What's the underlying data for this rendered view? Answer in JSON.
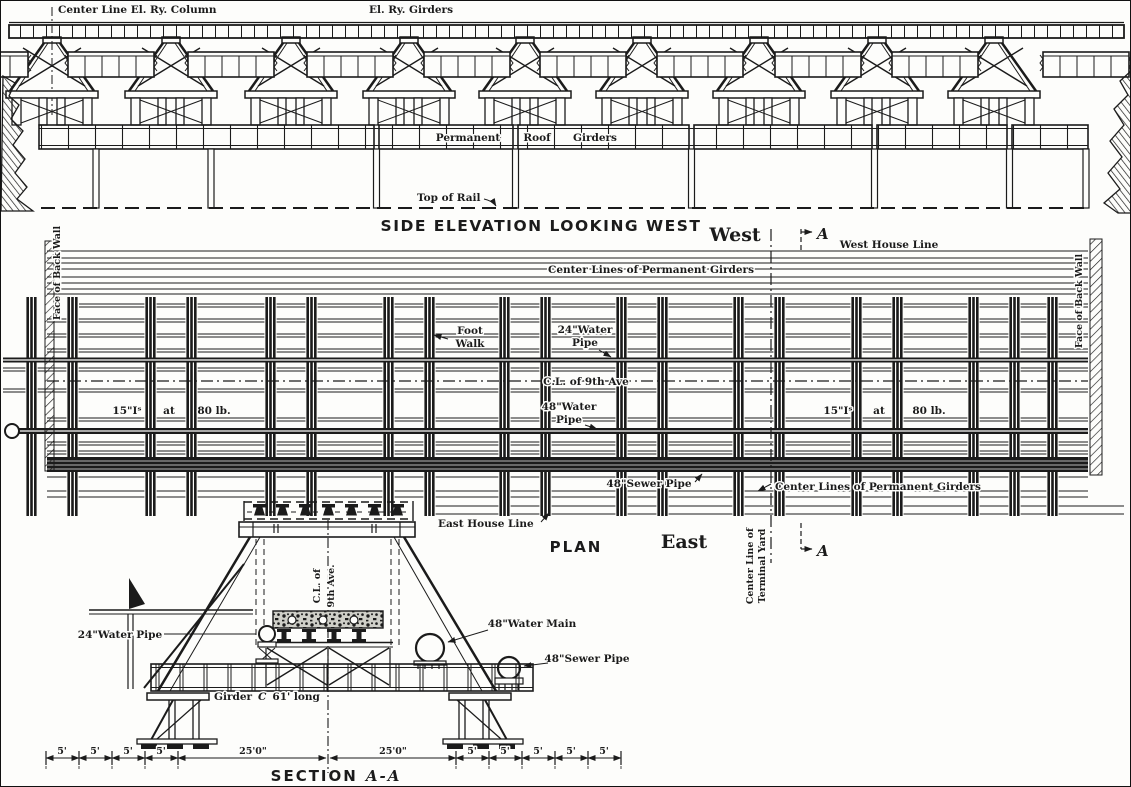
{
  "colors": {
    "ink": "#1b1b1b",
    "paper": "#fdfdfb"
  },
  "elevation": {
    "center_line_label": "Center Line El. Ry. Column",
    "girders_label": "El. Ry. Girders",
    "band_word_permanent": "Permanent",
    "band_word_roof": "Roof",
    "band_word_girders": "Girders",
    "top_of_rail": "Top of Rail",
    "title": "SIDE ELEVATION LOOKING WEST"
  },
  "plan": {
    "west": "West",
    "east": "East",
    "section_letter": "A",
    "west_house_line": "West House Line",
    "east_house_line": "East House Line",
    "center_lines_of_permanent_girders": "Center Lines of Permanent Girders",
    "foot_walk_1": "Foot",
    "foot_walk_2": "Walk",
    "water24_1": "24\"Water",
    "water24_2": "Pipe",
    "cl_9th_ave": "C.L. of 9th Ave",
    "water48_1": "48\"Water",
    "water48_2": "Pipe",
    "sewer48": "48\"Sewer Pipe",
    "ibeam_size": "15\"Iˢ",
    "ibeam_at": "at",
    "ibeam_weight": "80 lb.",
    "face_of_back_wall": "Face of Back Wall",
    "terminal_yard_1": "Center Line of",
    "terminal_yard_2": "Terminal Yard",
    "title": "PLAN"
  },
  "section": {
    "cl_1": "C.L. of",
    "cl_2": "9th Ave.",
    "water24": "24\"Water Pipe",
    "water_main48": "48\"Water Main",
    "sewer48": "48\"Sewer Pipe",
    "girder_word": "Girder",
    "girder_c": "C",
    "girder_len": "61' long",
    "dim_5": "5'",
    "dim_25": "25'0\"",
    "title_section": "SECTION",
    "title_aa": "A-A"
  }
}
